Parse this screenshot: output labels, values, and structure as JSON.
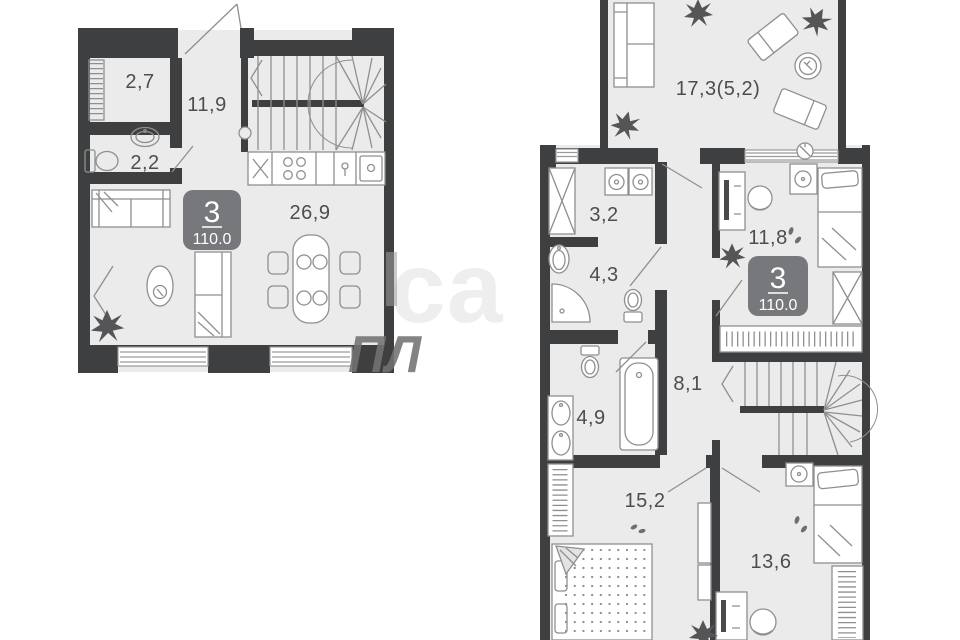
{
  "plans": {
    "first_level": {
      "badge": {
        "rooms_count": "3",
        "total_area": "110.0"
      },
      "rooms": [
        {
          "name": "wardrobe",
          "area_label": "2,7"
        },
        {
          "name": "hallway",
          "area_label": "11,9"
        },
        {
          "name": "bathroom",
          "area_label": "2,2"
        },
        {
          "name": "living-kitchen",
          "area_label": "26,9"
        }
      ]
    },
    "second_level": {
      "badge": {
        "rooms_count": "3",
        "total_area": "110.0"
      },
      "rooms": [
        {
          "name": "terrace",
          "area_label": "17,3(5,2)"
        },
        {
          "name": "laundry",
          "area_label": "3,2"
        },
        {
          "name": "bedroom-1",
          "area_label": "11,8"
        },
        {
          "name": "shower-room",
          "area_label": "4,3"
        },
        {
          "name": "hall",
          "area_label": "8,1"
        },
        {
          "name": "bathroom",
          "area_label": "4,9"
        },
        {
          "name": "bedroom-2",
          "area_label": "15,2"
        },
        {
          "name": "bedroom-3",
          "area_label": "13,6"
        }
      ]
    }
  },
  "watermark": {
    "light_fragment": "са",
    "dark_fragment": "ПЛ"
  },
  "colors": {
    "wall": "#3e3f41",
    "floor": "#ebebeb",
    "furniture": "#8f8f8f",
    "label": "#4d4d4d",
    "badge_bg": "#77787b",
    "badge_text": "#ffffff",
    "plant": "#555557",
    "background": "#ffffff"
  }
}
